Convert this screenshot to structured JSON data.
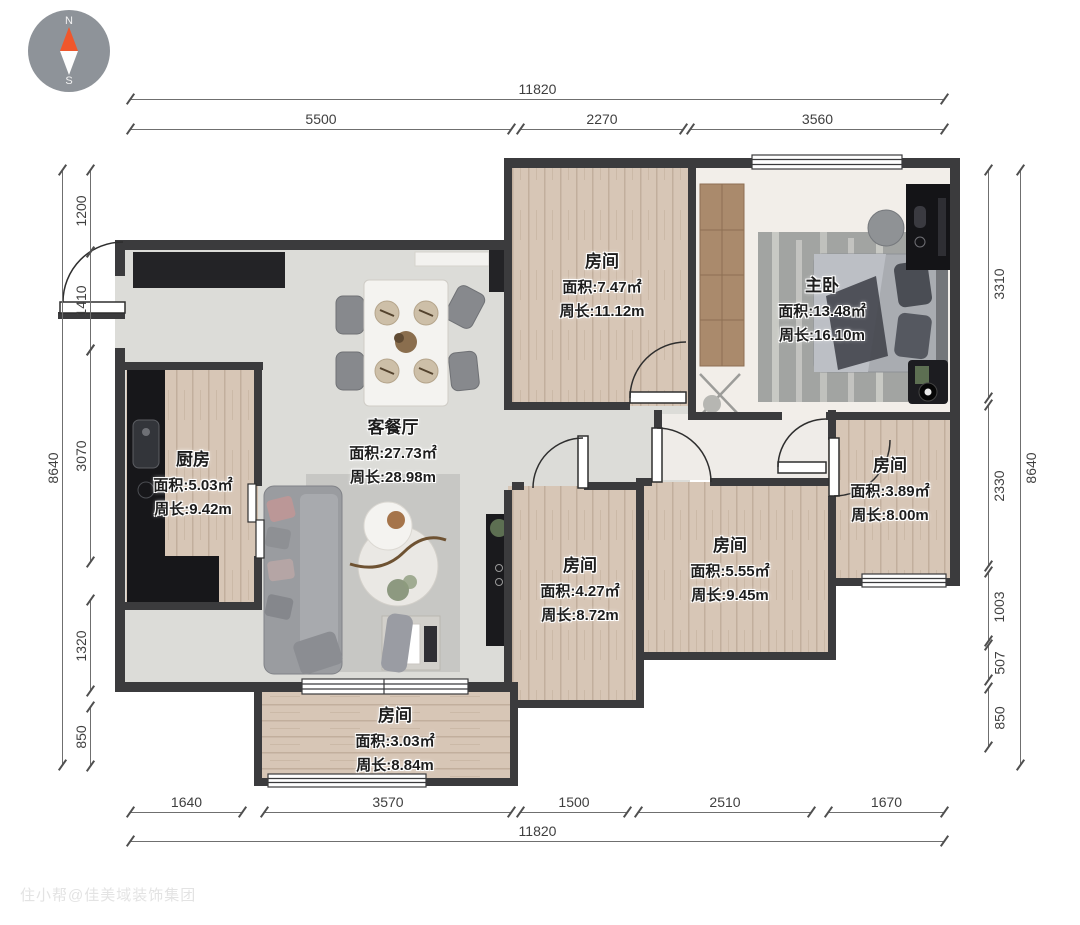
{
  "compass": {
    "north": "N",
    "south": "S"
  },
  "watermark_text": "住小帮@佳美域装饰集团",
  "colors": {
    "wall": "#3b3b3d",
    "wood_floor": "#d7c6b6",
    "living_floor": "#dcdcd8",
    "counter_black": "#17171a",
    "north_needle": "#f0572c"
  },
  "rooms": [
    {
      "id": "living-dining",
      "name": "客餐厅",
      "area_label": "面积:27.73㎡",
      "perimeter_label": "周长:28.98m"
    },
    {
      "id": "kitchen",
      "name": "厨房",
      "area_label": "面积:5.03㎡",
      "perimeter_label": "周长:9.42m"
    },
    {
      "id": "bedroom-top",
      "name": "房间",
      "area_label": "面积:7.47㎡",
      "perimeter_label": "周长:11.12m"
    },
    {
      "id": "master-bedroom",
      "name": "主卧",
      "area_label": "面积:13.48㎡",
      "perimeter_label": "周长:16.10m"
    },
    {
      "id": "room-center",
      "name": "房间",
      "area_label": "面积:4.27㎡",
      "perimeter_label": "周长:8.72m"
    },
    {
      "id": "room-center-right",
      "name": "房间",
      "area_label": "面积:5.55㎡",
      "perimeter_label": "周长:9.45m"
    },
    {
      "id": "room-right",
      "name": "房间",
      "area_label": "面积:3.89㎡",
      "perimeter_label": "周长:8.00m"
    },
    {
      "id": "balcony-room",
      "name": "房间",
      "area_label": "面积:3.03㎡",
      "perimeter_label": "周长:8.84m"
    }
  ],
  "dimensions": {
    "top": {
      "total": "11820",
      "segments": [
        "5500",
        "2270",
        "3560"
      ]
    },
    "bottom": {
      "total": "11820",
      "segments": [
        "1640",
        "3570",
        "1500",
        "2510",
        "1670"
      ]
    },
    "left": {
      "total": "8640",
      "segments": [
        "1200",
        "1410",
        "3070",
        "1320",
        "850"
      ]
    },
    "right": {
      "total": "8640",
      "segments": [
        "3310",
        "2330",
        "1003",
        "507",
        "850"
      ]
    }
  }
}
